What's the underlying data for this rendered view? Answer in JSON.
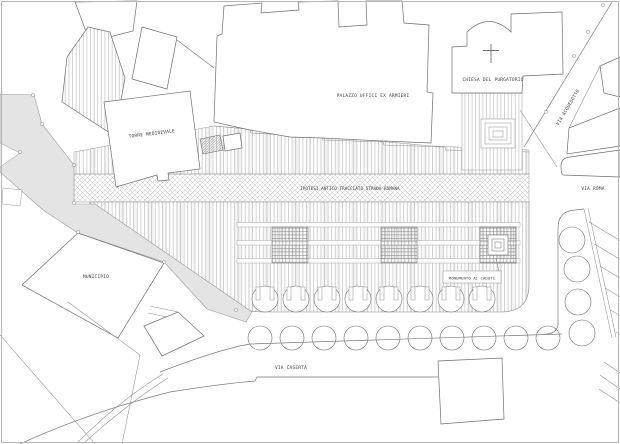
{
  "drawing": {
    "background": "#ffffff",
    "line_color": "#6e6e6e",
    "hatch_color": "#aeaeae",
    "road_fill": "#e4e4e4",
    "labels": {
      "torre": "TORRE MEDIOEVALE",
      "palazzo": "PALAZZO UFFICI EX ARMIERI",
      "chiesa": "CHIESA DEL PURGATORIO",
      "strada_romana": "IPOTESI ANTICO TRACCIATO STRADA ROMANA",
      "monumento": "MONUMENTO AI CADUTI",
      "municipio": "MUNICIPIO",
      "via_caserta": "VIA CASERTA",
      "via_roma": "VIA ROMA",
      "via_acquedotto": "VIA ACQUEDOTTO"
    }
  }
}
